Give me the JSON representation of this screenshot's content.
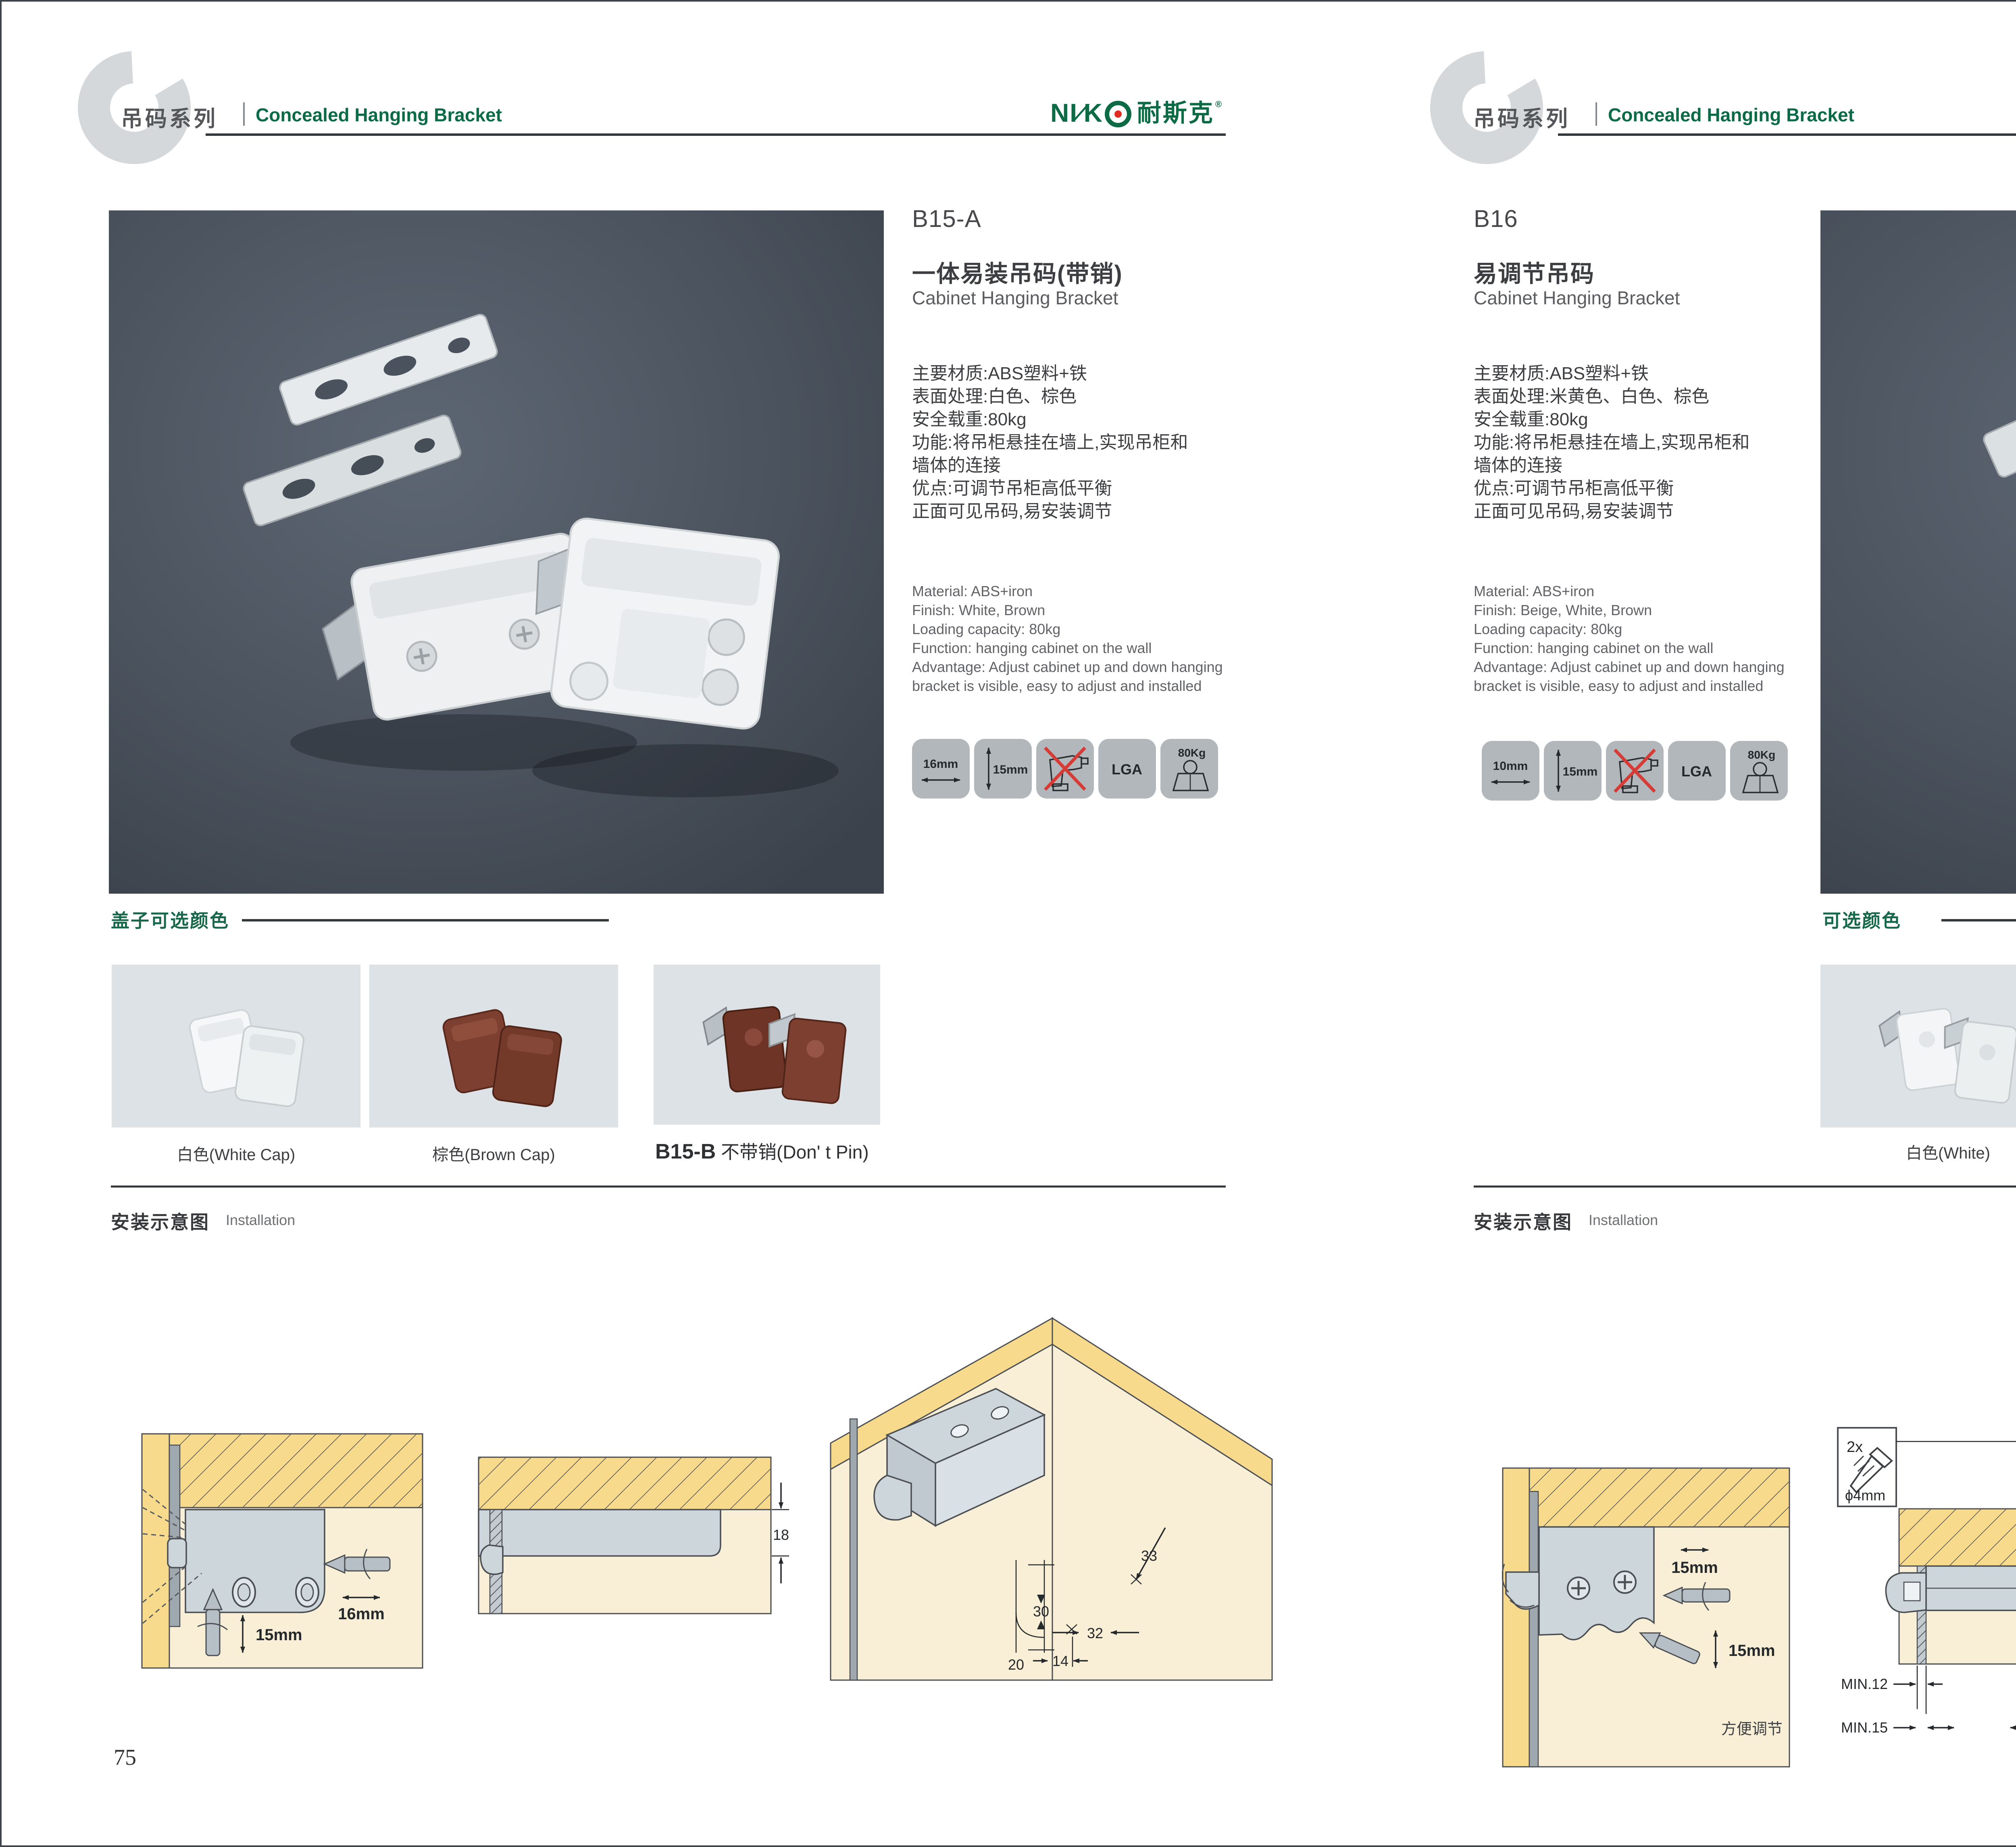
{
  "brand": {
    "latin": "NI",
    "slash": "∕",
    "k": "K",
    "cn": "耐斯克",
    "reg": "®"
  },
  "left": {
    "header": {
      "letter": "C",
      "series_zh": "吊码系列",
      "series_en": "Concealed Hanging Bracket"
    },
    "product": {
      "code": "B15-A",
      "name_zh": "一体易装吊码(带销)",
      "name_en": "Cabinet Hanging Bracket",
      "specs_zh": [
        "主要材质:ABS塑料+铁",
        "表面处理:白色、棕色",
        "安全载重:80kg",
        "功能:将吊柜悬挂在墙上,实现吊柜和",
        "墙体的连接",
        "优点:可调节吊柜高低平衡",
        "正面可见吊码,易安装调节"
      ],
      "specs_en": [
        "Material: ABS+iron",
        "Finish: White, Brown",
        "Loading capacity: 80kg",
        "Function: hanging cabinet on the wall",
        "Advantage: Adjust cabinet up and down hanging",
        "bracket is visible, easy to adjust and installed"
      ],
      "badges": {
        "b1": "16mm",
        "b2": "15mm",
        "b4": "LGA",
        "b5": "80Kg"
      }
    },
    "colors": {
      "heading": "盖子可选颜色",
      "cap1": "白色(White Cap)",
      "cap2": "棕色(Brown Cap)",
      "variant_code": "B15-B",
      "variant_name": "不带销(Don' t Pin)"
    },
    "install": {
      "zh": "安装示意图",
      "en": "Installation",
      "d1": {
        "dim1": "16mm",
        "dim2": "15mm"
      },
      "d2": {
        "dim1": "18"
      },
      "d3": {
        "dim1": "33",
        "dim2": "30",
        "dim3": "32",
        "dim4": "20",
        "dim5": "14"
      }
    },
    "page_no": "75"
  },
  "right": {
    "header": {
      "letter": "C",
      "series_zh": "吊码系列",
      "series_en": "Concealed Hanging Bracket"
    },
    "product": {
      "code": "B16",
      "name_zh": "易调节吊码",
      "name_en": "Cabinet Hanging Bracket",
      "specs_zh": [
        "主要材质:ABS塑料+铁",
        "表面处理:米黄色、白色、棕色",
        "安全载重:80kg",
        "功能:将吊柜悬挂在墙上,实现吊柜和",
        "墙体的连接",
        "优点:可调节吊柜高低平衡",
        "正面可见吊码,易安装调节"
      ],
      "specs_en": [
        "Material: ABS+iron",
        "Finish: Beige, White, Brown",
        "Loading capacity: 80kg",
        "Function: hanging cabinet on the wall",
        "Advantage: Adjust cabinet up and down hanging",
        "bracket is visible, easy to adjust and installed"
      ],
      "badges": {
        "b1": "10mm",
        "b2": "15mm",
        "b4": "LGA",
        "b5": "80Kg"
      }
    },
    "colors": {
      "heading": "可选颜色",
      "cap1": "白色(White)",
      "cap2": "棕色(Brown )",
      "cap3": "米黄色(Beige)"
    },
    "install": {
      "zh": "安装示意图",
      "en": "Installation",
      "d1": {
        "dim1": "15mm",
        "dim2": "15mm",
        "note": "方便调节"
      },
      "d2": {
        "qty": "2x",
        "dia": "ϕ4mm",
        "dim1": "19",
        "min1": "MIN.12",
        "min2": "MIN.15"
      },
      "d3": {
        "dim1": "30",
        "dim2": "32",
        "dim3": "RMAX4",
        "dim4": "19",
        "dim5": "20",
        "dim6": "32"
      }
    },
    "page_no": "76"
  }
}
